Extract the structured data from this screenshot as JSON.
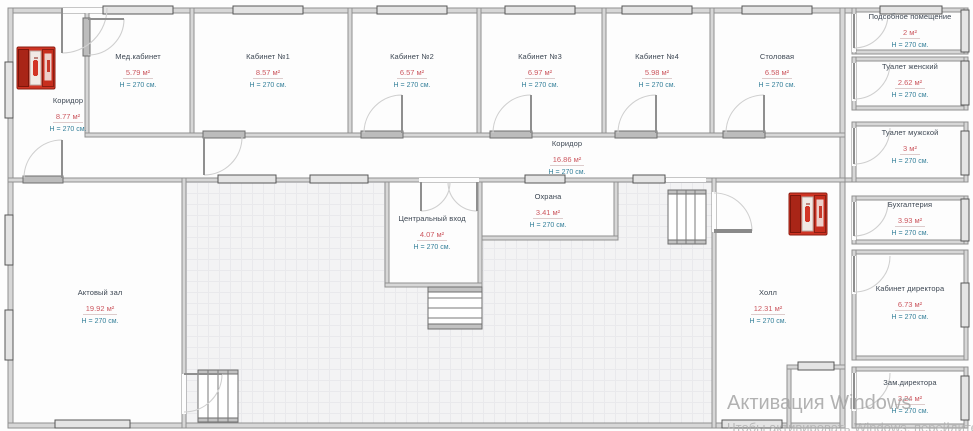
{
  "watermark": {
    "line1": "Активация Windows",
    "line2": "Чтобы активировать Windows, перейдите в раздел \"Параметры\"."
  },
  "rooms": [
    {
      "id": "med-kabinet",
      "name": "Мед.кабинет",
      "area": "5.79 м²",
      "height": "H = 270 см."
    },
    {
      "id": "kabinet-1",
      "name": "Кабинет №1",
      "area": "8.57 м²",
      "height": "H = 270 см."
    },
    {
      "id": "kabinet-2",
      "name": "Кабинет №2",
      "area": "6.57 м²",
      "height": "H = 270 см."
    },
    {
      "id": "kabinet-3",
      "name": "Кабинет №3",
      "area": "6.97 м²",
      "height": "H = 270 см."
    },
    {
      "id": "kabinet-4",
      "name": "Кабинет №4",
      "area": "5.98 м²",
      "height": "H = 270 см."
    },
    {
      "id": "stolovaya",
      "name": "Столовая",
      "area": "6.58 м²",
      "height": "H = 270 см."
    },
    {
      "id": "koridor-left",
      "name": "Коридор",
      "area": "8.77 м²",
      "height": "H = 270 см."
    },
    {
      "id": "koridor-main",
      "name": "Коридор",
      "area": "16.86 м²",
      "height": "H = 270 см."
    },
    {
      "id": "podsobnoe",
      "name": "Подсобное помещение",
      "area": "2 м²",
      "height": "H = 270 см."
    },
    {
      "id": "tualet-zhenskiy",
      "name": "Туалет женский",
      "area": "2.62 м²",
      "height": "H = 270 см."
    },
    {
      "id": "tualet-muzhskoy",
      "name": "Туалет мужской",
      "area": "3 м²",
      "height": "H = 270 см."
    },
    {
      "id": "buhgalteriya",
      "name": "Бухгалтерия",
      "area": "3.93 м²",
      "height": "H = 270 см."
    },
    {
      "id": "kabinet-direktora",
      "name": "Кабинет директора",
      "area": "6.73 м²",
      "height": "H = 270 см."
    },
    {
      "id": "zam-direktora",
      "name": "Зам.директора",
      "area": "3.24 м²",
      "height": "H = 270 см."
    },
    {
      "id": "centralnyy-vhod",
      "name": "Центральный вход",
      "area": "4.07 м²",
      "height": "H = 270 см."
    },
    {
      "id": "ohrana",
      "name": "Охрана",
      "area": "3.41 м²",
      "height": "H = 270 см."
    },
    {
      "id": "aktovyy-zal",
      "name": "Актовый зал",
      "area": "19.92 м²",
      "height": "H = 270 см."
    },
    {
      "id": "holl",
      "name": "Холл",
      "area": "12.31 м²",
      "height": "H = 270 см."
    }
  ]
}
